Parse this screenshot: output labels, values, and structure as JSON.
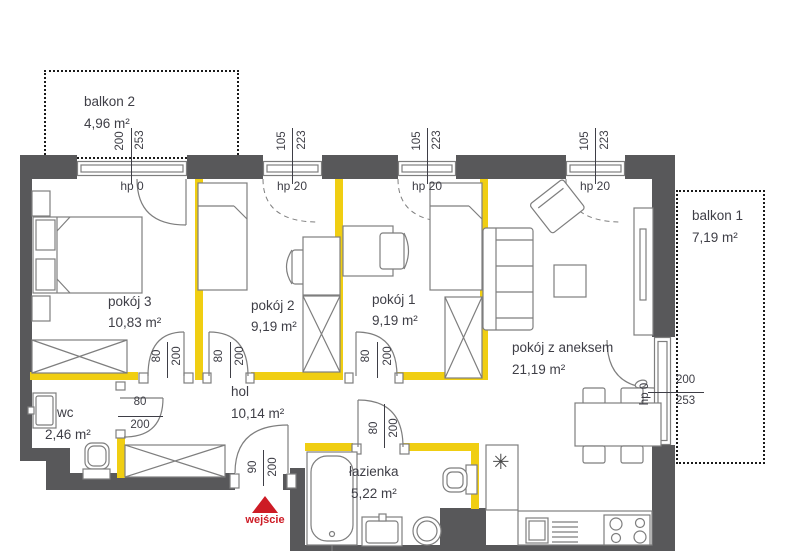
{
  "plan": {
    "balconies": [
      {
        "name": "balkon 2",
        "area": "4,96 m²"
      },
      {
        "name": "balkon 1",
        "area": "7,19 m²"
      }
    ],
    "rooms": [
      {
        "name": "pokój 3",
        "area": "10,83 m²"
      },
      {
        "name": "pokój 2",
        "area": "9,19 m²"
      },
      {
        "name": "pokój 1",
        "area": "9,19 m²"
      },
      {
        "name": "pokój z aneksem",
        "area": "21,19 m²"
      },
      {
        "name": "hol",
        "area": "10,14 m²"
      },
      {
        "name": "wc",
        "area": "2,46 m²"
      },
      {
        "name": "łazienka",
        "area": "5,22 m²"
      }
    ],
    "windows": [
      {
        "w": "200",
        "h": "253",
        "hp": "hp 0"
      },
      {
        "w": "105",
        "h": "223",
        "hp": "hp 20"
      },
      {
        "w": "105",
        "h": "223",
        "hp": "hp 20"
      },
      {
        "w": "105",
        "h": "223",
        "hp": "hp 20"
      }
    ],
    "balcony_door": {
      "w": "200",
      "h": "253",
      "hp": "hp 0"
    },
    "doors": [
      {
        "w": "80",
        "h": "200"
      },
      {
        "w": "80",
        "h": "200"
      },
      {
        "w": "80",
        "h": "200"
      },
      {
        "w": "80",
        "h": "200"
      },
      {
        "w": "80",
        "h": "200"
      },
      {
        "w": "90",
        "h": "200"
      }
    ],
    "entrance": {
      "label": "wejście"
    },
    "symbols": {
      "kitchen_star": "✳"
    },
    "colors": {
      "wall": "#58585a",
      "partition": "#f0ce12",
      "red": "#cd1b25",
      "line": "#7e7e7e",
      "text": "#3e3e46",
      "dash": "#1a1a1a"
    }
  }
}
